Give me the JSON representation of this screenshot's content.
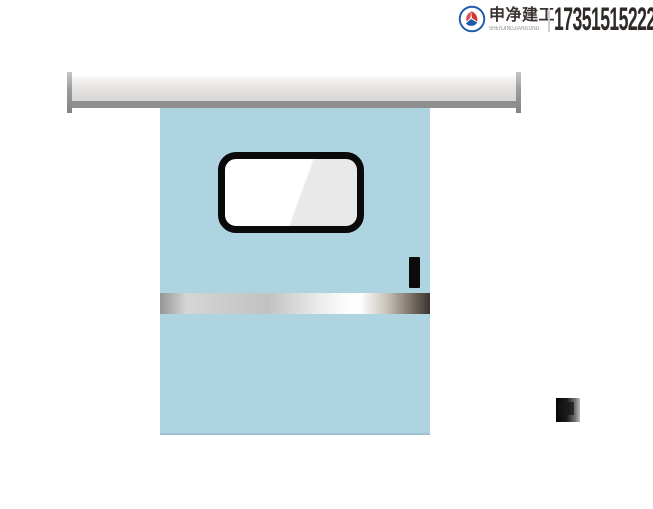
{
  "header": {
    "brand_name": "申净建工",
    "brand_romanized": "SHENJINGJIANGONG",
    "phone": "17351515222"
  },
  "icons": {
    "brand_logo": "brand-logo-icon (blue ring with red/blue pinwheel swirl)"
  },
  "scene": {
    "description_elements": {
      "track_rail": "horizontal gray track rail with dark end caps",
      "door_panel": "light blue sliding door leaf",
      "door_window": "rounded rectangle window with black frame and glass glare",
      "door_handle": "small black vertical handle bar",
      "kick_plate": "horizontal stainless-steel strip across door",
      "wall_switch": "small dark square switch on wall at right"
    }
  },
  "colors": {
    "door_blue": "#aed3e1",
    "rail_band_gray": "#8f8f8f",
    "window_frame_black": "#0a0a0a",
    "handle_black": "#0b0b0b",
    "brand_red": "#d6342c",
    "brand_blue": "#1e5cab",
    "phone_text": "#2e2a28"
  }
}
